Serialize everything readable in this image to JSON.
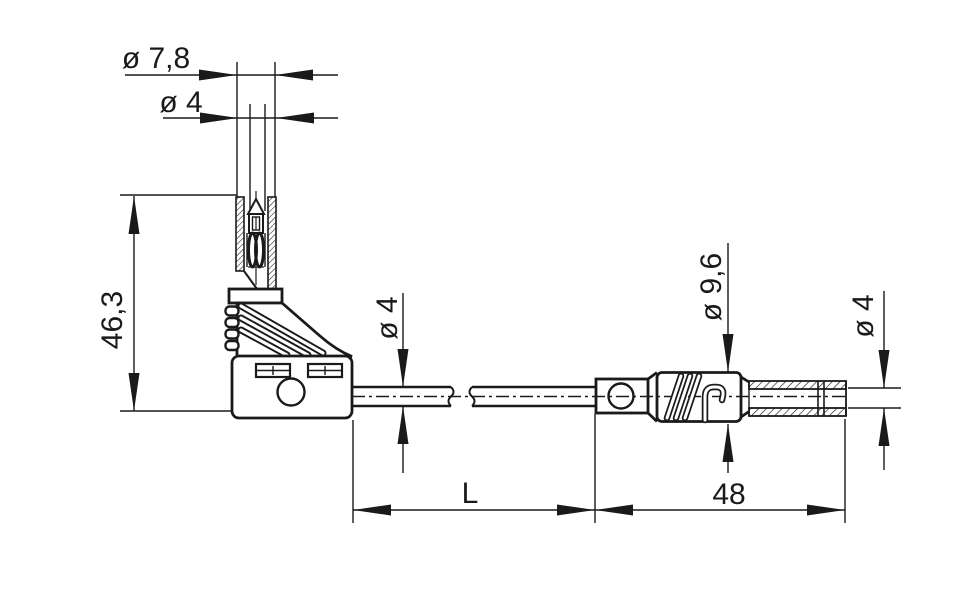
{
  "colors": {
    "line": "#1a1a1a",
    "background": "#ffffff"
  },
  "labels": {
    "sleeve_diameter": "ø 7,8",
    "tip_diameter": "ø 4",
    "plug_height": "46,3",
    "cable_diameter": "ø 4",
    "body_diameter": "ø 9,6",
    "pin_diameter": "ø 4",
    "cable_length": "L",
    "plug_length": "48"
  }
}
